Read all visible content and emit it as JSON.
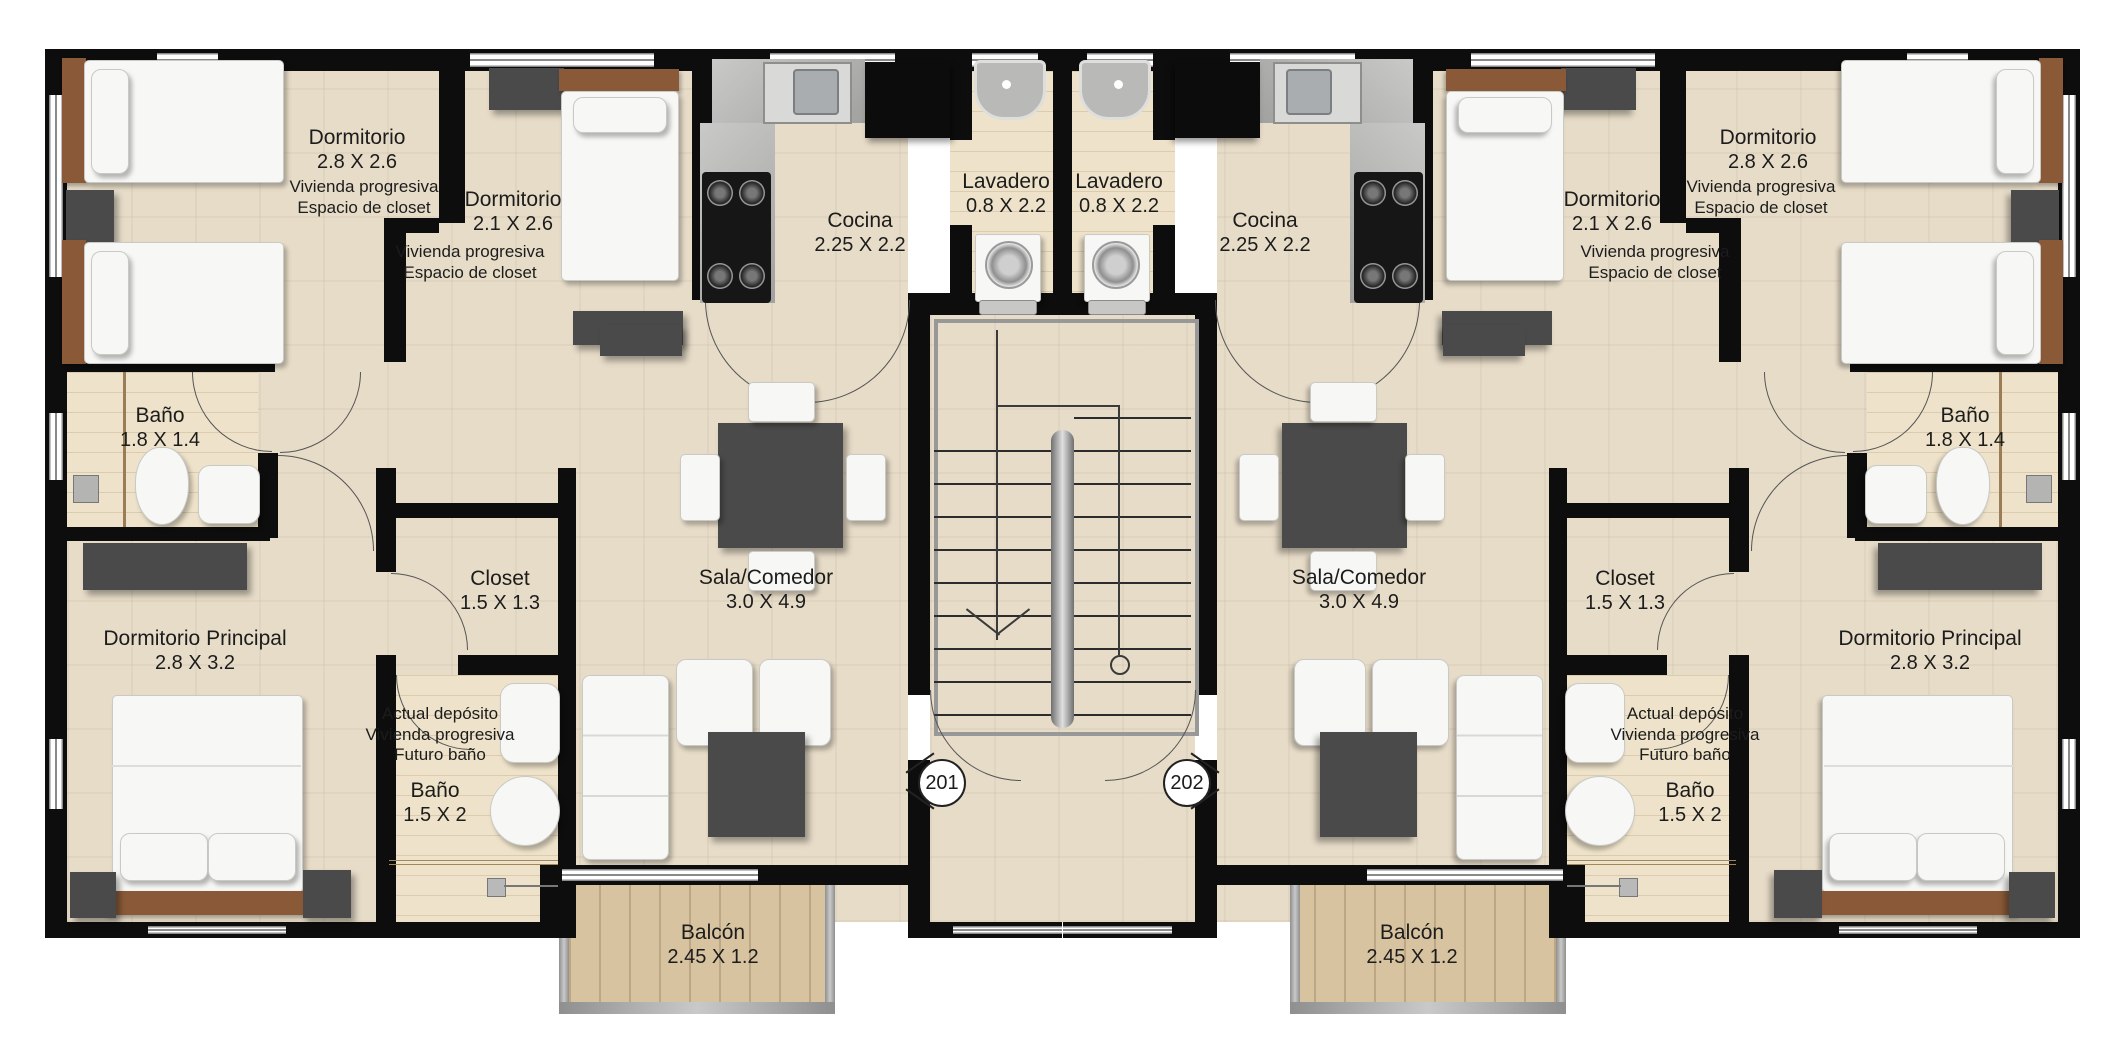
{
  "colors": {
    "wall": "#0d0d0d",
    "floor": "#e7dcc8",
    "floor_wood": "#eee3ca",
    "tile": "#d8c3a0",
    "counter": "#b7b7b5",
    "furniture_dark": "#4a4a4a",
    "furniture_white": "#f7f7f5",
    "wood": "#8a5a38",
    "line": "#555555"
  },
  "rooms": {
    "dormitorio_a": {
      "name": "Dormitorio",
      "dims": "2.8 X 2.6"
    },
    "dormitorio_b": {
      "name": "Dormitorio",
      "dims": "2.1 X 2.6"
    },
    "cocina": {
      "name": "Cocina",
      "dims": "2.25 X 2.2"
    },
    "lavadero": {
      "name": "Lavadero",
      "dims": "0.8 X 2.2"
    },
    "bano_a": {
      "name": "Baño",
      "dims": "1.8 X 1.4"
    },
    "closet": {
      "name": "Closet",
      "dims": "1.5 X 1.3"
    },
    "dormitorio_principal": {
      "name": "Dormitorio Principal",
      "dims": "2.8 X 3.2"
    },
    "bano_b": {
      "name": "Baño",
      "dims": "1.5 X 2"
    },
    "sala": {
      "name": "Sala/Comedor",
      "dims": "3.0 X 4.9"
    },
    "balcon": {
      "name": "Balcón",
      "dims": "2.45 X 1.2"
    }
  },
  "notes": {
    "progresiva": {
      "line1": "Vivienda progresiva",
      "line2": "Espacio de closet"
    },
    "deposito": {
      "line1": "Actual depósito",
      "line2": "Vivienda progresiva",
      "line3": "Futuro baño"
    }
  },
  "units": {
    "left": {
      "door_number": "201"
    },
    "right": {
      "door_number": "202"
    }
  }
}
